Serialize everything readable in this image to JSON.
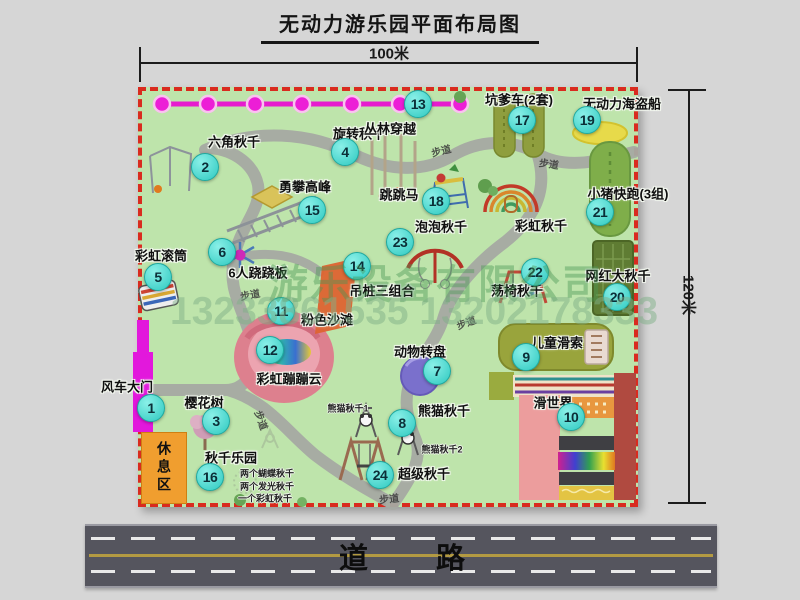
{
  "title": "无动力游乐园平面布局图",
  "dimensions": {
    "top": "100米",
    "right": "120米"
  },
  "road": {
    "label": "道 路"
  },
  "rest_area": {
    "label": "休息区"
  },
  "watermark": {
    "company": "游乐设备有限公司",
    "phone": "13233861535 13202178333"
  },
  "colors": {
    "map_bg": "#bee4ab",
    "boundary_red": "#d92b1f",
    "marker_cyan": "#3fd6ce",
    "zipline_magenta": "#e81ecc",
    "road_gray": "#55555e",
    "gate_magenta": "#e218dc",
    "rest_orange": "#f09e2f"
  },
  "attractions": [
    {
      "num": "1",
      "label": "风车大门",
      "lx": 127,
      "ly": 386,
      "mx": 151,
      "my": 408
    },
    {
      "num": "2",
      "label": "六角秋千",
      "lx": 234,
      "ly": 141,
      "mx": 205,
      "my": 167
    },
    {
      "num": "3",
      "label": "樱花树",
      "lx": 204,
      "ly": 402,
      "mx": 216,
      "my": 421
    },
    {
      "num": "4",
      "label": "旋转秋千",
      "lx": 359,
      "ly": 133,
      "mx": 345,
      "my": 152
    },
    {
      "num": "5",
      "label": "彩虹滚筒",
      "lx": 161,
      "ly": 255,
      "mx": 158,
      "my": 277
    },
    {
      "num": "6",
      "label": "6人跷跷板",
      "lx": 258,
      "ly": 272,
      "mx": 222,
      "my": 252
    },
    {
      "num": "7",
      "label": "动物转盘",
      "lx": 420,
      "ly": 351,
      "mx": 437,
      "my": 371
    },
    {
      "num": "8",
      "label": "熊猫秋千",
      "lx": 444,
      "ly": 410,
      "mx": 402,
      "my": 423,
      "subs": [
        {
          "text": "熊猫秋千1",
          "x": 348,
          "y": 408
        },
        {
          "text": "熊猫秋千2",
          "x": 442,
          "y": 449
        }
      ]
    },
    {
      "num": "9",
      "label": "儿童滑索",
      "lx": 557,
      "ly": 342,
      "mx": 526,
      "my": 357
    },
    {
      "num": "10",
      "label": "滑世界",
      "lx": 553,
      "ly": 402,
      "mx": 571,
      "my": 417
    },
    {
      "num": "11",
      "label": "粉色沙滩",
      "lx": 327,
      "ly": 319,
      "mx": 281,
      "my": 311
    },
    {
      "num": "12",
      "label": "彩虹蹦蹦云",
      "lx": 289,
      "ly": 378,
      "mx": 270,
      "my": 350
    },
    {
      "num": "13",
      "label": "丛林穿越",
      "lx": 390,
      "ly": 128,
      "mx": 418,
      "my": 104
    },
    {
      "num": "14",
      "label": "吊桩三组合",
      "lx": 382,
      "ly": 290,
      "mx": 357,
      "my": 266
    },
    {
      "num": "15",
      "label": "勇攀高峰",
      "lx": 305,
      "ly": 186,
      "mx": 312,
      "my": 210
    },
    {
      "num": "16",
      "label": "秋千乐园",
      "lx": 231,
      "ly": 457,
      "mx": 210,
      "my": 477,
      "subs": [
        {
          "text": "两个蝴蝶秋千",
          "x": 267,
          "y": 473
        },
        {
          "text": "两个发光秋千",
          "x": 267,
          "y": 486
        },
        {
          "text": "一个彩虹秋千",
          "x": 265,
          "y": 498
        }
      ]
    },
    {
      "num": "17",
      "label": "坑爹车(2套)",
      "lx": 519,
      "ly": 99,
      "mx": 522,
      "my": 120
    },
    {
      "num": "18",
      "label": "跳跳马",
      "lx": 399,
      "ly": 194,
      "mx": 436,
      "my": 201
    },
    {
      "num": "19",
      "label": "无动力海盗船",
      "lx": 622,
      "ly": 103,
      "mx": 587,
      "my": 120
    },
    {
      "num": "20",
      "label": "网红大秋千",
      "lx": 618,
      "ly": 275,
      "mx": 617,
      "my": 297
    },
    {
      "num": "21",
      "label": "小猪快跑(3组)",
      "lx": 628,
      "ly": 193,
      "mx": 600,
      "my": 212
    },
    {
      "num": "22",
      "label": "荡椅秋千",
      "lx": 517,
      "ly": 290,
      "mx": 535,
      "my": 272
    },
    {
      "num": "23",
      "label": "泡泡秋千",
      "lx": 441,
      "ly": 226,
      "mx": 400,
      "my": 242
    },
    {
      "num": "24",
      "label": "超级秋千",
      "lx": 424,
      "ly": 473,
      "mx": 380,
      "my": 475
    }
  ],
  "extra_labels": [
    {
      "text": "彩虹秋千",
      "x": 541,
      "y": 225
    }
  ],
  "path_labels": [
    {
      "text": "步道",
      "x": 250,
      "y": 294,
      "rot": -10
    },
    {
      "text": "步道",
      "x": 441,
      "y": 150,
      "rot": -14
    },
    {
      "text": "步道",
      "x": 549,
      "y": 163,
      "rot": 8
    },
    {
      "text": "步道",
      "x": 466,
      "y": 322,
      "rot": -20
    },
    {
      "text": "步道",
      "x": 389,
      "y": 498,
      "rot": -6
    },
    {
      "text": "步道",
      "x": 262,
      "y": 420,
      "rot": 70
    }
  ]
}
